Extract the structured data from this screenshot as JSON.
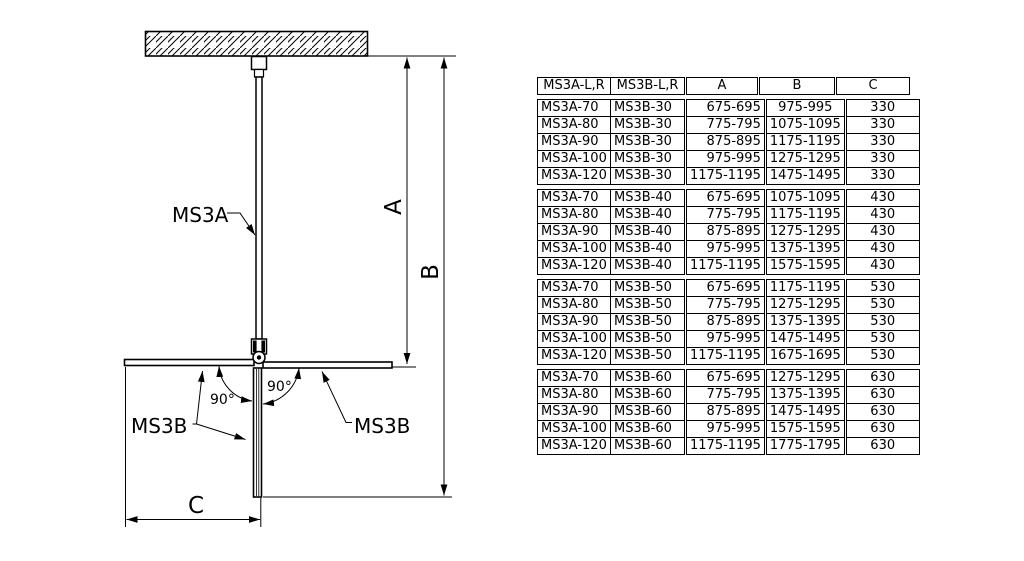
{
  "diagram": {
    "pole_label": "MS3A",
    "panel_label_left": "MS3B",
    "panel_label_right": "MS3B",
    "angle_left": "90°",
    "angle_right": "90°",
    "dim_a": "A",
    "dim_b": "B",
    "dim_c": "C"
  },
  "table": {
    "headers": [
      "MS3A-L,R",
      "MS3B-L,R",
      "A",
      "B",
      "C"
    ],
    "blocks": [
      {
        "rows": [
          [
            "MS3A-70",
            "MS3B-30",
            "675-695",
            "975-995",
            "330"
          ],
          [
            "MS3A-80",
            "MS3B-30",
            "775-795",
            "1075-1095",
            "330"
          ],
          [
            "MS3A-90",
            "MS3B-30",
            "875-895",
            "1175-1195",
            "330"
          ],
          [
            "MS3A-100",
            "MS3B-30",
            "975-995",
            "1275-1295",
            "330"
          ],
          [
            "MS3A-120",
            "MS3B-30",
            "1175-1195",
            "1475-1495",
            "330"
          ]
        ]
      },
      {
        "rows": [
          [
            "MS3A-70",
            "MS3B-40",
            "675-695",
            "1075-1095",
            "430"
          ],
          [
            "MS3A-80",
            "MS3B-40",
            "775-795",
            "1175-1195",
            "430"
          ],
          [
            "MS3A-90",
            "MS3B-40",
            "875-895",
            "1275-1295",
            "430"
          ],
          [
            "MS3A-100",
            "MS3B-40",
            "975-995",
            "1375-1395",
            "430"
          ],
          [
            "MS3A-120",
            "MS3B-40",
            "1175-1195",
            "1575-1595",
            "430"
          ]
        ]
      },
      {
        "rows": [
          [
            "MS3A-70",
            "MS3B-50",
            "675-695",
            "1175-1195",
            "530"
          ],
          [
            "MS3A-80",
            "MS3B-50",
            "775-795",
            "1275-1295",
            "530"
          ],
          [
            "MS3A-90",
            "MS3B-50",
            "875-895",
            "1375-1395",
            "530"
          ],
          [
            "MS3A-100",
            "MS3B-50",
            "975-995",
            "1475-1495",
            "530"
          ],
          [
            "MS3A-120",
            "MS3B-50",
            "1175-1195",
            "1675-1695",
            "530"
          ]
        ]
      },
      {
        "rows": [
          [
            "MS3A-70",
            "MS3B-60",
            "675-695",
            "1275-1295",
            "630"
          ],
          [
            "MS3A-80",
            "MS3B-60",
            "775-795",
            "1375-1395",
            "630"
          ],
          [
            "MS3A-90",
            "MS3B-60",
            "875-895",
            "1475-1495",
            "630"
          ],
          [
            "MS3A-100",
            "MS3B-60",
            "975-995",
            "1575-1595",
            "630"
          ],
          [
            "MS3A-120",
            "MS3B-60",
            "1175-1195",
            "1775-1795",
            "630"
          ]
        ]
      }
    ]
  }
}
